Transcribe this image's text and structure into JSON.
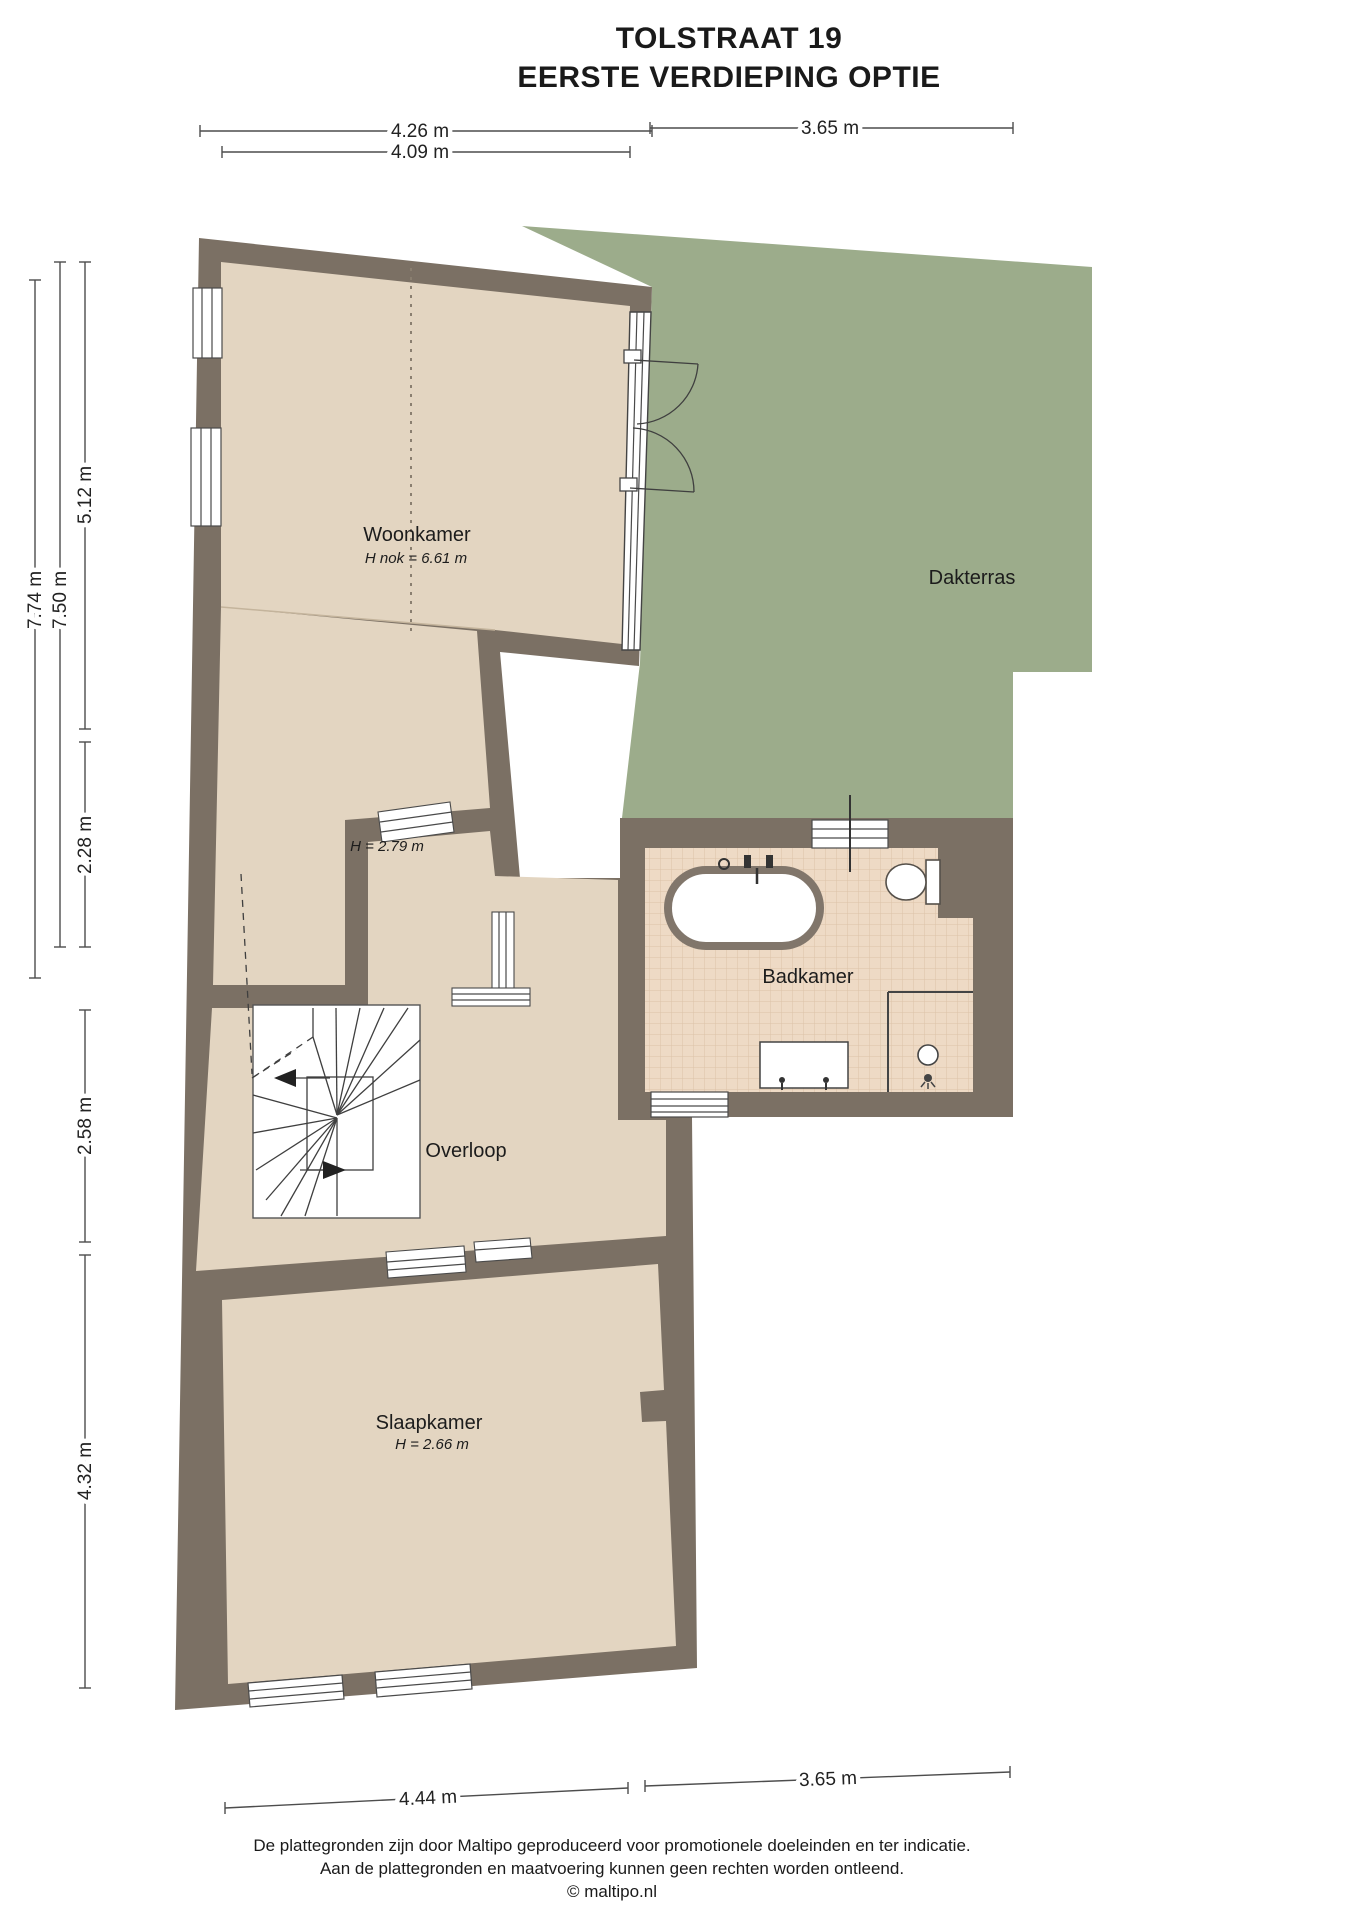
{
  "title": {
    "line1": "TOLSTRAAT 19",
    "line2": "EERSTE VERDIEPING OPTIE"
  },
  "rooms": {
    "woonkamer": {
      "label": "Woonkamer",
      "note": "H nok = 6.61 m"
    },
    "woonkamer_lower": {
      "note": "H = 2.79 m"
    },
    "dakterras": {
      "label": "Dakterras"
    },
    "badkamer": {
      "label": "Badkamer"
    },
    "overloop": {
      "label": "Overloop"
    },
    "slaapkamer": {
      "label": "Slaapkamer",
      "note": "H = 2.66 m"
    }
  },
  "dimensions": {
    "top_outer": "4.26 m",
    "top_inner": "4.09 m",
    "top_right": "3.65 m",
    "left_total": "7.74 m",
    "left_inner_total": "7.50 m",
    "left_upper": "5.12 m",
    "left_mid": "2.28 m",
    "left_stair": "2.58 m",
    "left_lower": "4.32 m",
    "bottom_left": "4.44 m",
    "bottom_right": "3.65 m"
  },
  "footer": {
    "line1": "De plattegronden zijn door Maltipo geproduceerd voor promotionele doeleinden en ter indicatie.",
    "line2": "Aan de plattegronden en maatvoering kunnen geen rechten worden ontleend.",
    "line3": "© maltipo.nl"
  },
  "colors": {
    "wall": "#7b7064",
    "floor": "#e3d5c1",
    "terrace": "#9cac8b",
    "tile": "#eedac5",
    "tile_line": "#dcc2a8"
  }
}
